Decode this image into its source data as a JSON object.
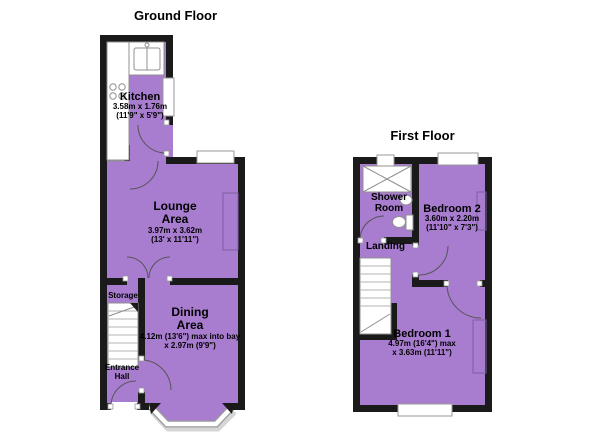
{
  "palette": {
    "room_fill": "#a87ccf",
    "wall": "#1a1a1a",
    "window_outline": "#9a9a9a",
    "arc": "#555555",
    "fixture_outline": "#909090",
    "alcove_line": "#7d5fa0",
    "shadow": "#d6d6d6"
  },
  "ground_floor": {
    "title": "Ground Floor",
    "kitchen": {
      "name": "Kitchen",
      "metric": "3.58m x 1.76m",
      "imperial": "(11'9\" x 5'9\")"
    },
    "lounge": {
      "name_line1": "Lounge",
      "name_line2": "Area",
      "metric": "3.97m x 3.62m",
      "imperial": "(13' x 11'11\")"
    },
    "dining": {
      "name_line1": "Dining",
      "name_line2": "Area",
      "metric": "4.12m (13'6\") max into bay",
      "imperial": "x 2.97m (9'9\")"
    },
    "storage": {
      "name": "Storage"
    },
    "entrance_hall": {
      "name_line1": "Entrance",
      "name_line2": "Hall"
    }
  },
  "first_floor": {
    "title": "First Floor",
    "shower_room": {
      "name_line1": "Shower",
      "name_line2": "Room"
    },
    "landing": {
      "name": "Landing"
    },
    "bedroom2": {
      "name": "Bedroom 2",
      "metric": "3.60m x 2.20m",
      "imperial": "(11'10\" x 7'3\")"
    },
    "bedroom1": {
      "name": "Bedroom 1",
      "metric": "4.97m (16'4\") max",
      "imperial": "x 3.63m (11'11\")"
    }
  }
}
